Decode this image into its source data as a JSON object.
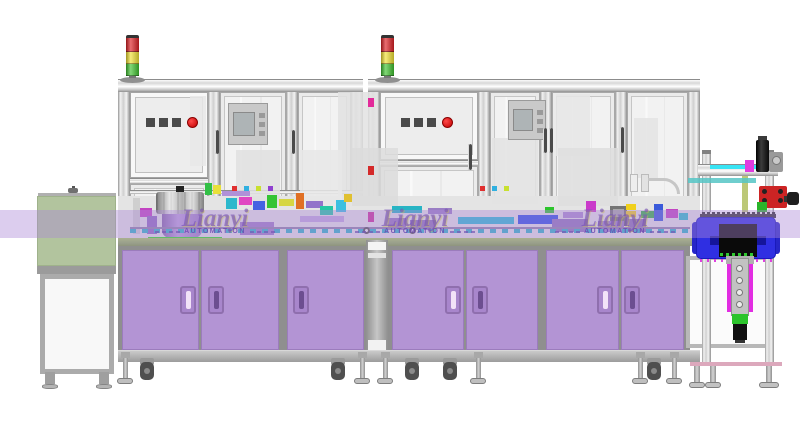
{
  "watermark": {
    "brand": "Lianyi",
    "subtitle": "AUTOMATION",
    "instances": 3,
    "centers_x": [
      215,
      415,
      615
    ]
  },
  "palette": {
    "cabinet_purple": "#b394d4",
    "cabinet_edge": "#9b7cbc",
    "frame_gray": "#e0e0e0",
    "glass": "#f2f2f2",
    "plinth": "#a6a6a6",
    "watermark_band": "rgba(172,136,214,0.42)",
    "green_unit": "#b2c49e",
    "blue_box": "#2f2fe2",
    "cyan_strip": "#38e4f4",
    "tower_red": "#dd1f24",
    "tower_yellow": "#f2e233",
    "tower_green": "#3fc32f",
    "stop_button_red": "#e81818",
    "bowl_purple": "#a98cc9",
    "belt_green": "#2de21c",
    "table_edge_green": "#9ba287"
  },
  "scene": {
    "towers": [
      126,
      381
    ],
    "tower_segments": [
      {
        "name": "red-light",
        "color": "#dd1f24",
        "h": 14
      },
      {
        "name": "yellow-light",
        "color": "#f2e233",
        "h": 12
      },
      {
        "name": "green-light",
        "color": "#3fc32f",
        "h": 12
      }
    ],
    "button_panels": [
      {
        "x": 146,
        "y": 118,
        "dark_buttons": 3,
        "stop_buttons": 1
      },
      {
        "x": 401,
        "y": 118,
        "dark_buttons": 3,
        "stop_buttons": 1
      }
    ],
    "frame_posts": [
      118,
      208,
      286,
      351,
      368,
      478,
      540,
      615,
      688
    ],
    "top_rails": [
      [
        118,
        79,
        245,
        13
      ],
      [
        368,
        79,
        332,
        13
      ]
    ],
    "mid_rails": [
      [
        130,
        178,
        78,
        6
      ],
      [
        380,
        160,
        98,
        6
      ],
      [
        130,
        190,
        233,
        4
      ],
      [
        380,
        200,
        320,
        4
      ]
    ],
    "glass_bays": [
      [
        220,
        92,
        66,
        146
      ],
      [
        298,
        92,
        53,
        146
      ],
      [
        490,
        92,
        50,
        146
      ],
      [
        552,
        92,
        63,
        146
      ],
      [
        627,
        92,
        61,
        146
      ],
      [
        130,
        184,
        78,
        54
      ],
      [
        380,
        166,
        98,
        72
      ]
    ],
    "opaque_bays": [
      [
        130,
        92,
        78,
        86
      ],
      [
        380,
        92,
        98,
        68
      ]
    ],
    "door_handles": [
      [
        215,
        130,
        24
      ],
      [
        291,
        130,
        24
      ],
      [
        468,
        144,
        26
      ],
      [
        543,
        128,
        25
      ],
      [
        549,
        128,
        25
      ],
      [
        620,
        127,
        26
      ]
    ],
    "hmi_boxes": [
      [
        228,
        103,
        40,
        42
      ],
      [
        508,
        100,
        38,
        40
      ]
    ],
    "silhouettes": [
      [
        338,
        92,
        40,
        104,
        "#e2e2e2"
      ],
      [
        300,
        150,
        42,
        58,
        "#e7e7e7"
      ],
      [
        352,
        148,
        46,
        58,
        "#dcdcdc"
      ],
      [
        236,
        150,
        44,
        52,
        "#e1e1e1"
      ],
      [
        492,
        138,
        46,
        66,
        "#e3e3e3"
      ],
      [
        556,
        94,
        34,
        62,
        "#e6e6e6"
      ],
      [
        558,
        148,
        60,
        58,
        "#dedede"
      ],
      [
        634,
        118,
        24,
        60,
        "#e4e4e4"
      ],
      [
        190,
        96,
        16,
        70,
        "#e8e8e8"
      ]
    ],
    "machinery_blocks": [
      [
        140,
        208,
        12,
        9,
        "#c244c2"
      ],
      [
        133,
        198,
        7,
        36,
        "#cfcfcf"
      ],
      [
        147,
        216,
        10,
        18,
        "#8f6cc0"
      ],
      [
        205,
        183,
        7,
        12,
        "#32c046"
      ],
      [
        213,
        185,
        8,
        9,
        "#e8e03a"
      ],
      [
        222,
        191,
        28,
        5,
        "#b091d8"
      ],
      [
        226,
        198,
        11,
        11,
        "#2cb8cc"
      ],
      [
        239,
        197,
        13,
        8,
        "#e046c2"
      ],
      [
        253,
        201,
        12,
        9,
        "#4462e2"
      ],
      [
        267,
        195,
        10,
        13,
        "#34c434"
      ],
      [
        279,
        199,
        15,
        7,
        "#d6d642"
      ],
      [
        296,
        193,
        8,
        16,
        "#e07024"
      ],
      [
        306,
        201,
        17,
        7,
        "#9274ca"
      ],
      [
        320,
        206,
        13,
        9,
        "#24c8a4"
      ],
      [
        240,
        222,
        34,
        13,
        "#9d7fc4"
      ],
      [
        300,
        216,
        44,
        6,
        "#c0aadc"
      ],
      [
        336,
        200,
        10,
        12,
        "#3cc0e0"
      ],
      [
        344,
        194,
        8,
        8,
        "#e0c030"
      ],
      [
        232,
        186,
        5,
        5,
        "#e03030"
      ],
      [
        244,
        186,
        5,
        5,
        "#30b0e0"
      ],
      [
        256,
        186,
        5,
        5,
        "#c8e030"
      ],
      [
        268,
        186,
        5,
        5,
        "#9040d0"
      ],
      [
        392,
        206,
        30,
        7,
        "#28b4c4"
      ],
      [
        428,
        208,
        24,
        6,
        "#9a7ec4"
      ],
      [
        458,
        217,
        56,
        7,
        "#2cbcd2"
      ],
      [
        518,
        215,
        40,
        9,
        "#3050e4"
      ],
      [
        545,
        207,
        9,
        6,
        "#2cc42c"
      ],
      [
        563,
        212,
        20,
        6,
        "#a98cce"
      ],
      [
        586,
        201,
        10,
        11,
        "#ca3aca"
      ],
      [
        610,
        206,
        17,
        20,
        "#747474"
      ],
      [
        613,
        209,
        11,
        8,
        "#a8a8a8"
      ],
      [
        626,
        204,
        10,
        6,
        "#f0d01c"
      ],
      [
        626,
        211,
        10,
        6,
        "#f0d01c"
      ],
      [
        641,
        211,
        13,
        7,
        "#34b244"
      ],
      [
        654,
        204,
        9,
        17,
        "#3a5ada"
      ],
      [
        666,
        209,
        12,
        9,
        "#c244c2"
      ],
      [
        679,
        213,
        9,
        7,
        "#2cc0c8"
      ],
      [
        552,
        219,
        36,
        13,
        "#8f76b8"
      ],
      [
        598,
        221,
        26,
        11,
        "#9a82c2"
      ],
      [
        628,
        219,
        18,
        13,
        "#8a72b2"
      ],
      [
        388,
        218,
        18,
        12,
        "#9478bc"
      ],
      [
        410,
        220,
        26,
        10,
        "#8d74b6"
      ],
      [
        368,
        98,
        6,
        9,
        "#e22a9a"
      ],
      [
        368,
        166,
        6,
        9,
        "#d42a2a"
      ],
      [
        368,
        212,
        6,
        10,
        "#ca329a"
      ],
      [
        480,
        186,
        5,
        5,
        "#e03030"
      ],
      [
        492,
        186,
        5,
        5,
        "#30b0e0"
      ],
      [
        504,
        186,
        5,
        5,
        "#c8e030"
      ]
    ],
    "cabinet_blocks": [
      [
        118,
        246,
        248,
        106
      ],
      [
        388,
        246,
        302,
        106
      ]
    ],
    "cabinet_doors": [
      [
        122,
        77
      ],
      [
        201,
        78
      ],
      [
        287,
        77
      ],
      [
        392,
        72
      ],
      [
        466,
        72
      ],
      [
        546,
        73
      ],
      [
        621,
        63
      ]
    ],
    "cabinet_handles": [
      [
        180,
        1
      ],
      [
        208,
        0
      ],
      [
        293,
        0
      ],
      [
        445,
        1
      ],
      [
        472,
        0
      ],
      [
        597,
        1
      ],
      [
        624,
        0
      ]
    ],
    "casters": [
      147,
      338,
      412,
      450,
      654
    ],
    "levelers": [
      125,
      362,
      385,
      478,
      640,
      674
    ],
    "bolt_rings": [
      363,
      409
    ]
  }
}
